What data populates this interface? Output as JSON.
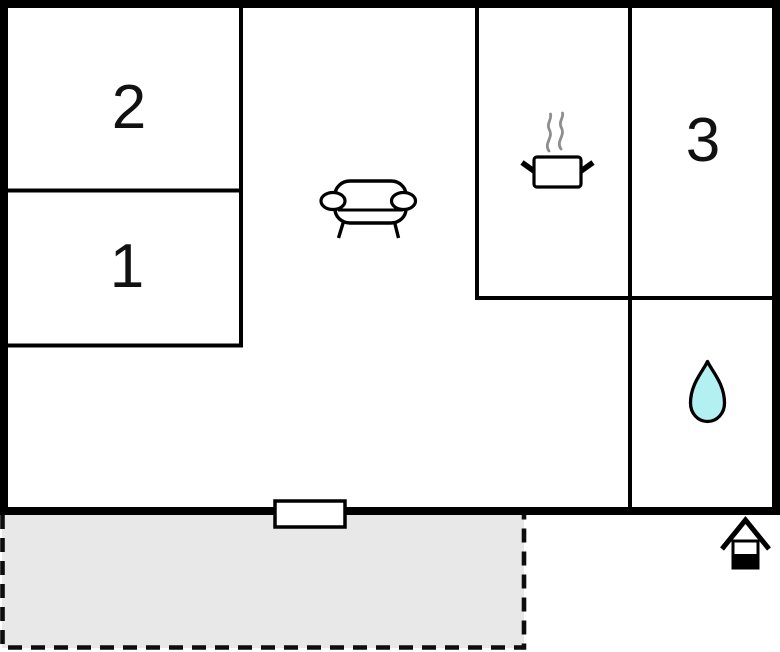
{
  "floorplan": {
    "type": "property-floor-plan",
    "rooms": [
      {
        "name": "bedroom-2",
        "label": "2"
      },
      {
        "name": "bedroom-1",
        "label": "1"
      },
      {
        "name": "bedroom-3",
        "label": "3"
      },
      {
        "name": "living-room",
        "icon": "sofa-icon",
        "label": ""
      },
      {
        "name": "kitchen",
        "icon": "cooking-pot-icon",
        "label": ""
      },
      {
        "name": "bathroom",
        "icon": "water-drop-icon",
        "label": ""
      },
      {
        "name": "terrace",
        "style": "dashed-outline",
        "label": ""
      }
    ],
    "markers": {
      "window_marker": "window-on-south-wall",
      "entrance_icon": "house-icon"
    },
    "colors": {
      "wall": "#000000",
      "floor": "#ffffff",
      "terrace_fill": "#e8e8e8",
      "water_drop": "#b2f0f1",
      "steam": "#8e8e8e",
      "label": "#111111"
    }
  }
}
